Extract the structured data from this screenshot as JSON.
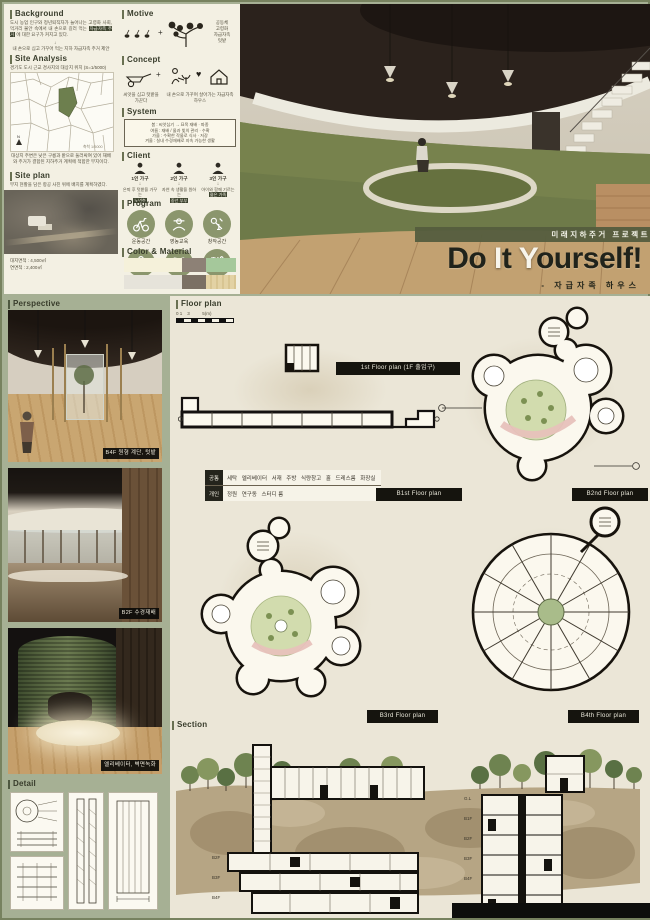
{
  "page": {
    "bg": "#a6b094",
    "panel": "#f3f0e3",
    "paper": "#ebe6d7",
    "accent": "#8b966d",
    "ink": "#383c2b",
    "pill_bg": "#15140e"
  },
  "title_block": {
    "band": "미래지하주거 프로젝트",
    "t1": "Do ",
    "t2": "I",
    "t3": "t ",
    "t4": "Y",
    "t5": "ourself!",
    "subtitle": "-  자급자족  하우스"
  },
  "background": {
    "title": "Background",
    "body1": "도시 농업 인구와 정년퇴직자가 늘어나는 고령화 사회, 먹거리 불안 속에서 내 손으로 길러 먹는 ",
    "body_hl": "자급자족 주거",
    "body2": " 에 대한 요구가 커지고 있다.",
    "arrow": "↓",
    "note": "내 손으로 심고 가꾸어 먹는 지하 자급자족 주거 제안"
  },
  "site_analysis": {
    "title": "Site Analysis",
    "caption": "경기도 도시 근교 경사지의 대상지 위치 (S=1/5000)",
    "map_scale": "축척 1/5000",
    "compass": "N",
    "map_note": "대상지 주변은 낮은 구릉과 밭으로 둘러싸여 있어 재배와 주거가 결합된 지하주거 계획에 적합한 부지이다."
  },
  "site_plan": {
    "title": "Site plan",
    "caption": "부지 현황을 담은 항공 사진 위에 배치를 계획하였다.",
    "stat1": "대지면적 : 4,500㎡",
    "stat2": "연면적 : 2,400㎡"
  },
  "motive": {
    "title": "Motive",
    "plus": "+",
    "labels": [
      "공동체",
      "고령화",
      "자급자족",
      "텃밭"
    ]
  },
  "concept": {
    "title": "Concept",
    "plus": "+",
    "heart": "♥",
    "cap1": "씨앗을 심고 텃밭을 가꾼다",
    "cap2": "내 손으로 가꾸며 살아가는 자급자족 하우스"
  },
  "system": {
    "title": "System",
    "lines": [
      "봄 : 씨앗심기 → 묘목 재배 · 파종",
      "여름 : 재배 / 물과 빛의 관리 · 수확",
      "가을 : 수확한 작물로 식사 · 저장",
      "겨울 : 실내 수경재배로 지속 가능한 생활"
    ]
  },
  "client": {
    "title": "Client",
    "arrow": "↓",
    "items": [
      {
        "name": "1인 가구",
        "desc": "은퇴 후 텃밭을 가꾸는",
        "focus": "노년층"
      },
      {
        "name": "2인 가구",
        "desc": "자연 속 생활을 원하는",
        "focus": "중년 부부"
      },
      {
        "name": "3인 가구",
        "desc": "아이와 함께 기르는",
        "focus": "젊은 가족"
      }
    ]
  },
  "program": {
    "title": "Program",
    "items": [
      {
        "icon": "exercise-bike-icon",
        "label": "운동공간"
      },
      {
        "icon": "farmer-icon",
        "label": "영농교육"
      },
      {
        "icon": "tools-icon",
        "label": "창작공간"
      },
      {
        "icon": "desk-icon",
        "label": "사무공간"
      },
      {
        "icon": "sprout-pot-icon",
        "label": "원예공간"
      },
      {
        "icon": "cutlery-icon",
        "label": "식당공간"
      }
    ]
  },
  "color_material": {
    "title": "Color & Material",
    "row1": [
      "#f5f1da",
      "#8d8176",
      "#a5c89b"
    ],
    "row2": [
      "#e6e3da",
      "#7b7064",
      "#e3d2a4"
    ]
  },
  "perspective": {
    "title": "Perspective",
    "captions": [
      "B4F 원형 계단, 텃밭",
      "B2F 수경재배",
      "엘리베이터, 벽면녹화"
    ]
  },
  "floor_plan": {
    "title": "Floor plan",
    "scale": "0 1    3          5(m)",
    "labels": [
      "1st Floor plan (1F 출입구)",
      "B1st Floor plan",
      "B2nd Floor plan",
      "B3rd Floor plan",
      "B4th Floor plan"
    ]
  },
  "legend": {
    "rows": [
      {
        "head": "공통",
        "cells": "세탁   엘리베이터   서재   주방   식량창고   홀   드레스룸   화장실"
      },
      {
        "head": "개인",
        "cells": "정원   연구동   스터디 룸"
      }
    ]
  },
  "section": {
    "title": "Section",
    "levels": [
      "G.L",
      "B1F",
      "B2F",
      "B3F",
      "B4F"
    ]
  },
  "detail": {
    "title": "Detail"
  }
}
